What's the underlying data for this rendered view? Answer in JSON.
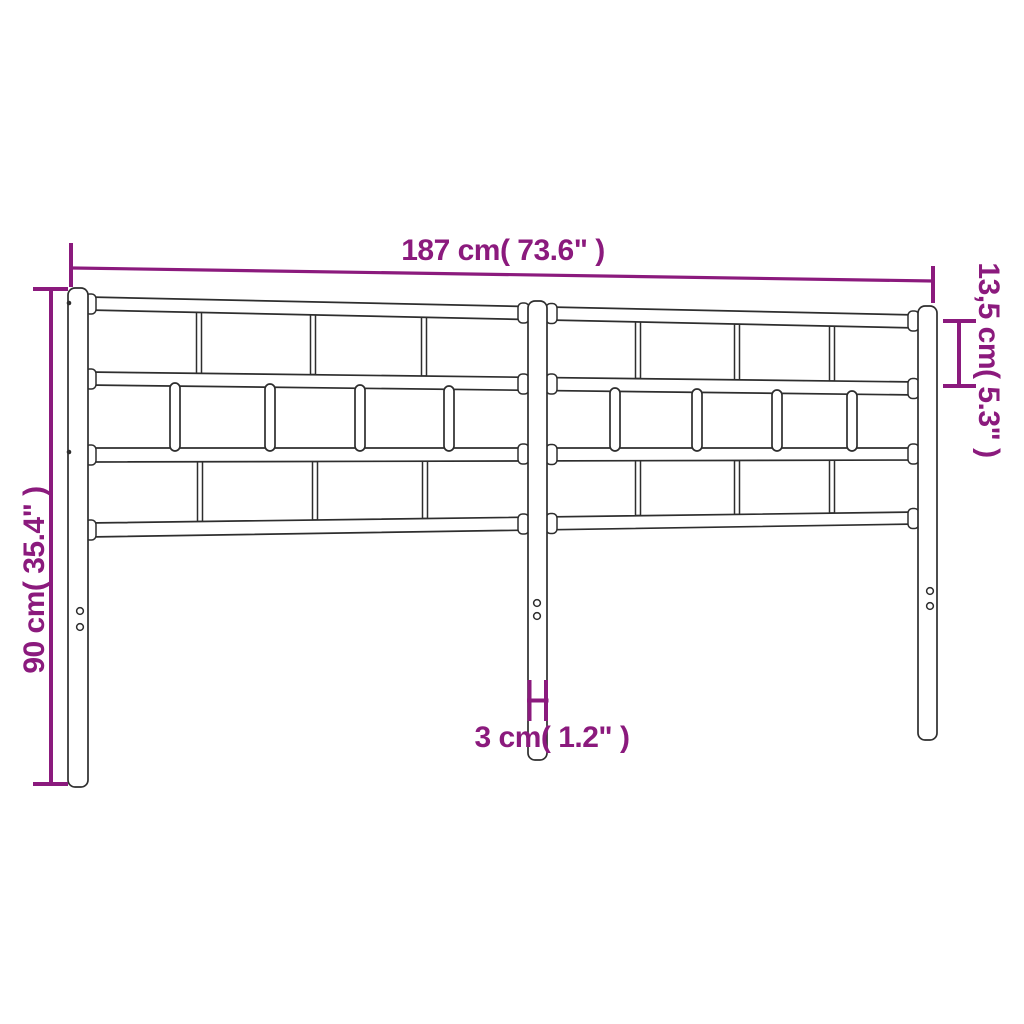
{
  "diagram": {
    "type": "product-dimension-diagram",
    "subject": "metal headboard with vertical slat grid, three posts",
    "colors": {
      "dimension_accent": "#8B1A7D",
      "line_art": "#2E2E2E",
      "background": "#FFFFFF"
    },
    "dimensions": {
      "width": {
        "label": "187 cm( 73.6\" )",
        "cm": "187",
        "inches": "73.6"
      },
      "top_section": {
        "label": "13,5 cm( 5.3\" )",
        "cm": "13,5",
        "inches": "5.3"
      },
      "height": {
        "label": "90 cm( 35.4\" )",
        "cm": "90",
        "inches": "35.4"
      },
      "post_width": {
        "label": "3 cm( 1.2\" )",
        "cm": "3",
        "inches": "1.2"
      }
    }
  }
}
